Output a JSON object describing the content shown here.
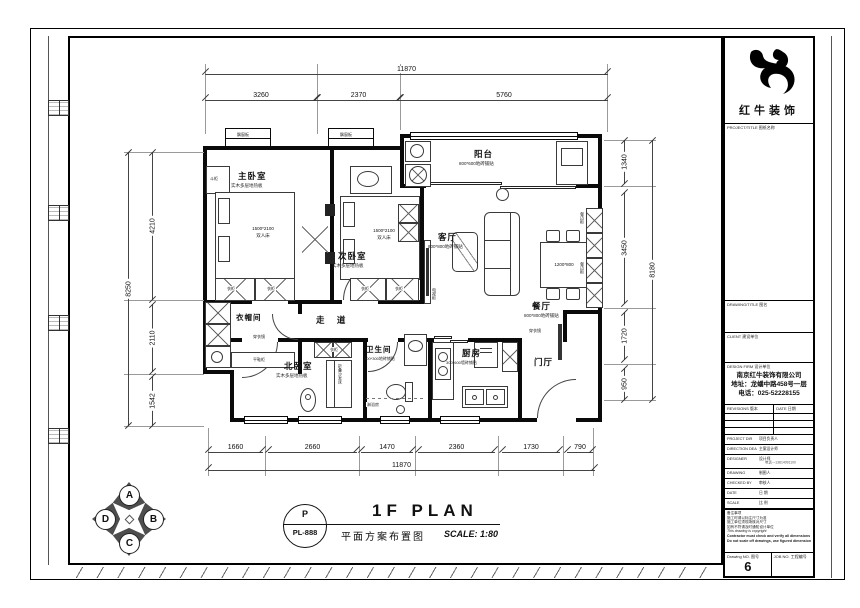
{
  "brand": {
    "name": "红牛装饰"
  },
  "titleblock": {
    "project_title_label": "PROJECT/TITLE 图纸名称",
    "drawing_title_label": "DRAWING/TITLE 图名",
    "client_label": "CLIENT 建设单位",
    "firm_label": "DESIGN FIRM 设计单位",
    "company": {
      "name": "南京红牛装饰有限公司",
      "address": "地址：龙蟠中路458号一层",
      "phone": "电话：025-52228155"
    },
    "revisions_label": "REVISIONS 版本",
    "date_col_label": "DATE 日期",
    "rows": [
      {
        "en": "PROJECT DIR",
        "cn": "项目负责人",
        "extra": ""
      },
      {
        "en": "DIRECTION DEA",
        "cn": "主案设计师",
        "extra": ""
      },
      {
        "en": "DESIGNER",
        "cn": "设计师",
        "extra": "电话—13814091100"
      },
      {
        "en": "DRAWING",
        "cn": "制图人",
        "extra": ""
      },
      {
        "en": "CHECKED BY",
        "cn": "审核人",
        "extra": ""
      },
      {
        "en": "DATE",
        "cn": "日 期",
        "extra": ""
      },
      {
        "en": "SCALE",
        "cn": "比 例",
        "extra": ""
      }
    ],
    "notes_title": "备注事项",
    "notes": [
      "施工时请以标注尺寸为准",
      "施工单位须现场核对尺寸",
      "如有不符请及时通知设计单位",
      "This drawing is copyright",
      "Contractor must check and verify all dimensions on site",
      "Do not scale off drawings, use figured dimensions only"
    ],
    "drawing_no_label": "Drawing NO. 图号",
    "drawing_no": "6",
    "job_no_label": "JOB NO. 工程编号"
  },
  "footer": {
    "stamp_top": "P",
    "stamp_no": "PL-888",
    "title": "1F PLAN",
    "subtitle": "平面方案布置图",
    "scale": "SCALE: 1:80"
  },
  "compass": {
    "n": "A",
    "e": "B",
    "s": "C",
    "w": "D"
  },
  "plan": {
    "rooms": {
      "master": {
        "name": "主卧室",
        "finish": "实木多层地热板"
      },
      "second": {
        "name": "次卧室",
        "finish": "实木多层地热板"
      },
      "north": {
        "name": "北卧室",
        "finish": "实木多层地热板"
      },
      "living": {
        "name": "客厅",
        "finish": "800*800地砖铺贴"
      },
      "dining": {
        "name": "餐厅",
        "finish": "800*800地砖铺贴"
      },
      "balcony": {
        "name": "阳台",
        "finish": "800*600地砖铺贴"
      },
      "kitchen": {
        "name": "厨房",
        "finish": "300*600墙砖铺贴"
      },
      "bath": {
        "name": "卫生间",
        "finish": "300*300地砖铺贴"
      },
      "corridor": {
        "name": "走 道"
      },
      "cloak": {
        "name": "衣帽间"
      },
      "hall": {
        "name": "门厅"
      }
    },
    "labels": {
      "bay": "飘窗板",
      "wardrobe": "衣柜",
      "chest": "斗柜",
      "mirror": "穿衣镜",
      "shoe": "平鞋柜",
      "sideboard": "餐边柜",
      "tv_cabinet": "电视柜",
      "sofa_bed": "折叠沙发床",
      "basin": "洗手台",
      "shower": "淋浴房",
      "bed_size": "1500*2100",
      "bed_type": "双人床",
      "table_size": "1200*800"
    }
  },
  "dims": {
    "top_total": "11870",
    "top": [
      "3260",
      "2370",
      "5760"
    ],
    "bottom": [
      "1660",
      "2660",
      "1470",
      "2360",
      "1730",
      "790"
    ],
    "bottom_total": "11870",
    "left": [
      "4210",
      "2110",
      "1542"
    ],
    "left_total": "8250",
    "right": [
      "1340",
      "3450",
      "1720",
      "950"
    ],
    "right_total": "8180"
  }
}
